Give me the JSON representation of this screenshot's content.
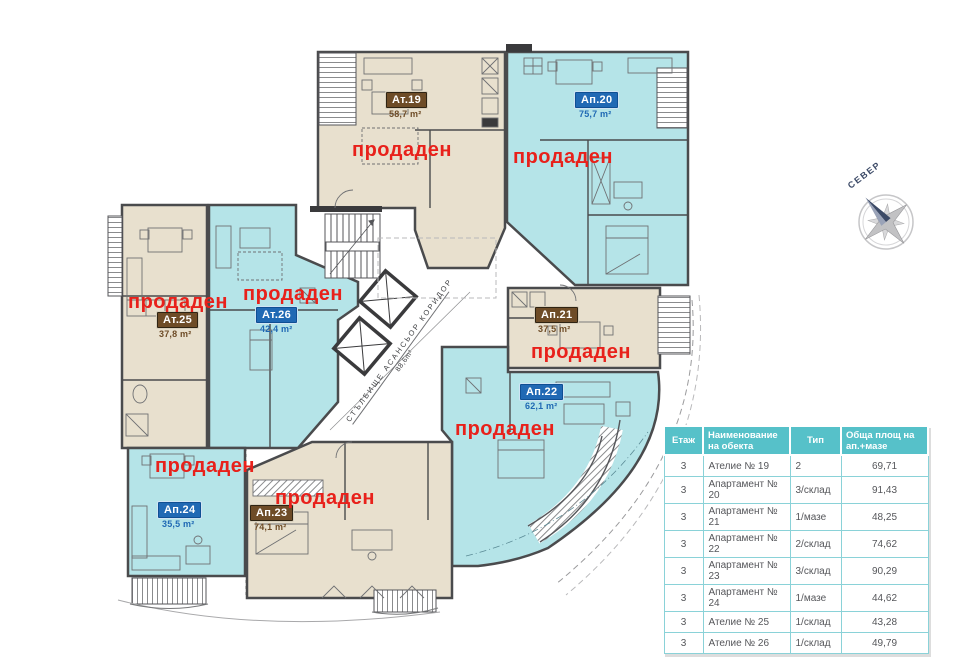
{
  "floor_plan": {
    "sold_text": "продаден",
    "compass_label": "СЕВЕР",
    "corridor": {
      "line1": "СТЪЛБИЩЕ  АСАНСЬОР  КОРИДОР",
      "line2": "88,6m²"
    },
    "units": [
      {
        "label": "Ат.19",
        "area": "58,7 m²",
        "badge": "brown",
        "status": "sold"
      },
      {
        "label": "Ап.20",
        "area": "75,7 m²",
        "badge": "blue",
        "status": "sold"
      },
      {
        "label": "Ат.25",
        "area": "37,8 m²",
        "badge": "brown",
        "status": "sold"
      },
      {
        "label": "Ат.26",
        "area": "42,4 m²",
        "badge": "blue",
        "status": "sold"
      },
      {
        "label": "Ап.21",
        "area": "37,5 m²",
        "badge": "brown",
        "status": "sold"
      },
      {
        "label": "Ап.22",
        "area": "62,1 m²",
        "badge": "blue",
        "status": "sold"
      },
      {
        "label": "Ап.24",
        "area": "35,5 m²",
        "badge": "blue",
        "status": "sold"
      },
      {
        "label": "Ап.23",
        "area": "74,1 m²",
        "badge": "brown",
        "status": "sold"
      }
    ]
  },
  "table": {
    "headers": [
      "Етаж",
      "Наименование на обекта",
      "Тип",
      "Обща площ на ап.+мазе"
    ],
    "rows": [
      [
        "3",
        "Ателие № 19",
        "2",
        "69,71"
      ],
      [
        "3",
        "Апартамент № 20",
        "3/склад",
        "91,43"
      ],
      [
        "3",
        "Апартамент № 21",
        "1/мазе",
        "48,25"
      ],
      [
        "3",
        "Апартамент № 22",
        "2/склад",
        "74,62"
      ],
      [
        "3",
        "Апартамент № 23",
        "3/склад",
        "90,29"
      ],
      [
        "3",
        "Апартамент № 24",
        "1/мазе",
        "44,62"
      ],
      [
        "3",
        "Ателие № 25",
        "1/склад",
        "43,28"
      ],
      [
        "3",
        "Ателие № 26",
        "1/склад",
        "49,79"
      ]
    ]
  },
  "colors": {
    "sold_red": "#e8211b",
    "badge_brown": "#6e4c27",
    "badge_blue": "#2069b4",
    "fill_beige": "#e8e0ce",
    "fill_cyan": "#b5e4e8",
    "table_teal": "#56c1c9",
    "wall": "#4a4b4d"
  }
}
